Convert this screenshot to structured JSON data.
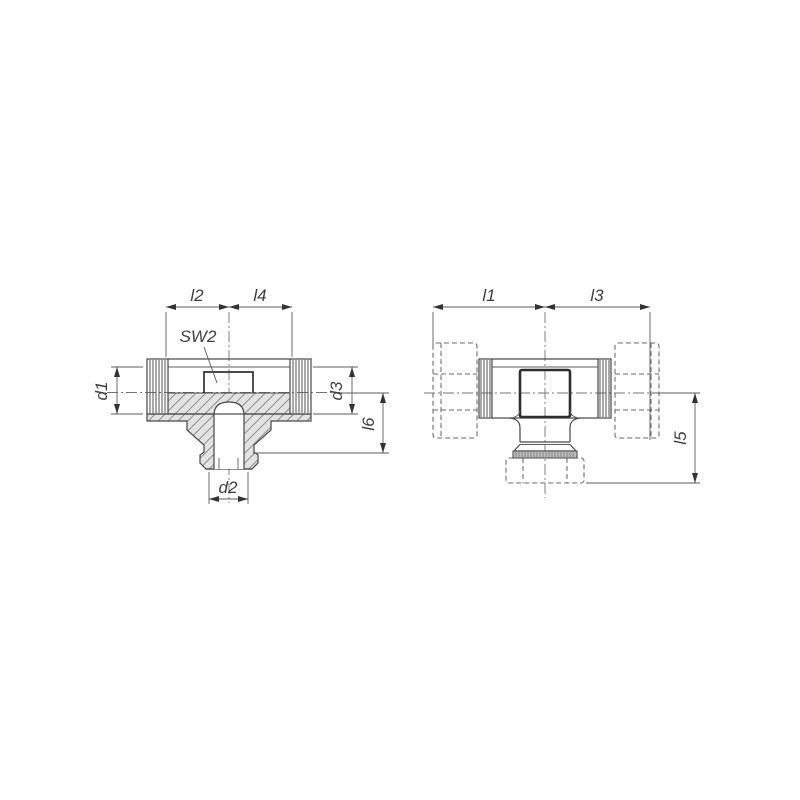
{
  "drawing": {
    "section_view": {
      "labels": {
        "l2": "l2",
        "l4": "l4",
        "sw": "SW2",
        "d1": "d1",
        "d3": "d3",
        "l6": "l6",
        "d2": "d2"
      }
    },
    "outside_view": {
      "labels": {
        "l1": "l1",
        "l3": "l3",
        "l5": "l5"
      }
    },
    "colors": {
      "background": "#ffffff",
      "outline": "#474747",
      "thin_line": "#5c5c5c",
      "dashed_line": "#6b6b6b",
      "centerline": "#757575",
      "section_fill": "#e3e3e3",
      "hatch_line": "#8d8d8d",
      "bold_line": "#2d2d2d",
      "label_text": "#3f3f3f"
    }
  }
}
